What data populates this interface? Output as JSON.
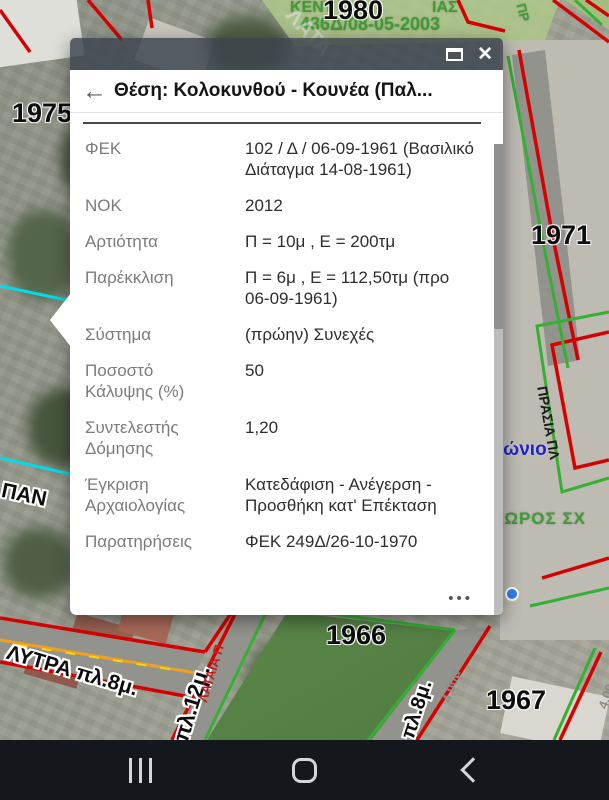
{
  "colors": {
    "line_red": "#d50000",
    "line_green": "#35b034",
    "line_cyan": "#00dcea",
    "street_orange": "#f0a020",
    "dash_yellow": "#ffd400",
    "label_blue": "#2323c8",
    "label_green": "#3f9c36",
    "popup_header": "#3a434d",
    "nav_bar": "#14171c",
    "marker_blue": "#2d7ff0"
  },
  "map": {
    "labels": {
      "kentro_left": "ΚΕΝΤ",
      "kentro_right": "ΙΑΣ",
      "decree": "436Δ/08-05-2003",
      "n1980": "1980",
      "n1975": "1975",
      "n1971": "1971",
      "n1966": "1966",
      "n1967": "1967",
      "lytra": "ΛΥΤΡΑ πλ.8μ.",
      "pl12": "πλ.12μ.",
      "lataia": "ΛΑΤΑΙΑ Π",
      "pan": "ΠΑΝ",
      "pl8": "πλ.8μ.",
      "w400a": "4,00μ",
      "w400b": "4,00μ",
      "diagonio": "Διαγώνιο",
      "o_frag": "ό",
      "xoros": "ΧΩΡΟΣ ΣΧ",
      "prasia": "ΠΡΑΣΙΑ ΠΛ",
      "lata": "ΛΑΤΑ",
      "pr": "ΠΡ"
    }
  },
  "popup": {
    "back_glyph": "←",
    "close_glyph": "✕",
    "title": "Θέση: Κολοκυνθού - Κουνέα (Παλ...",
    "rows": [
      {
        "label": "ΦΕΚ",
        "value": "102 / Δ / 06-09-1961 (Βασιλικό Διάταγμα 14-08-1961)"
      },
      {
        "label": "ΝΟΚ",
        "value": "2012"
      },
      {
        "label": "Αρτιότητα",
        "value": "Π = 10μ , Ε = 200τμ"
      },
      {
        "label": "Παρέκκλιση",
        "value": "Π = 6μ , Ε = 112,50τμ (προ 06-09-1961)"
      },
      {
        "label": "Σύστημα",
        "value": "(πρώην) Συνεχές"
      },
      {
        "label": "Ποσοστό Κάλυψης (%)",
        "value": "50"
      },
      {
        "label": "Συντελεστής Δόμησης",
        "value": "1,20"
      },
      {
        "label": "Έγκριση Αρχαιολογίας",
        "value": "Κατεδάφιση - Ανέγερση - Προσθήκη κατ' Επέκταση"
      },
      {
        "label": "Παρατηρήσεις",
        "value": "ΦΕΚ 249Δ/26-10-1970"
      }
    ],
    "more_label": "•••"
  }
}
